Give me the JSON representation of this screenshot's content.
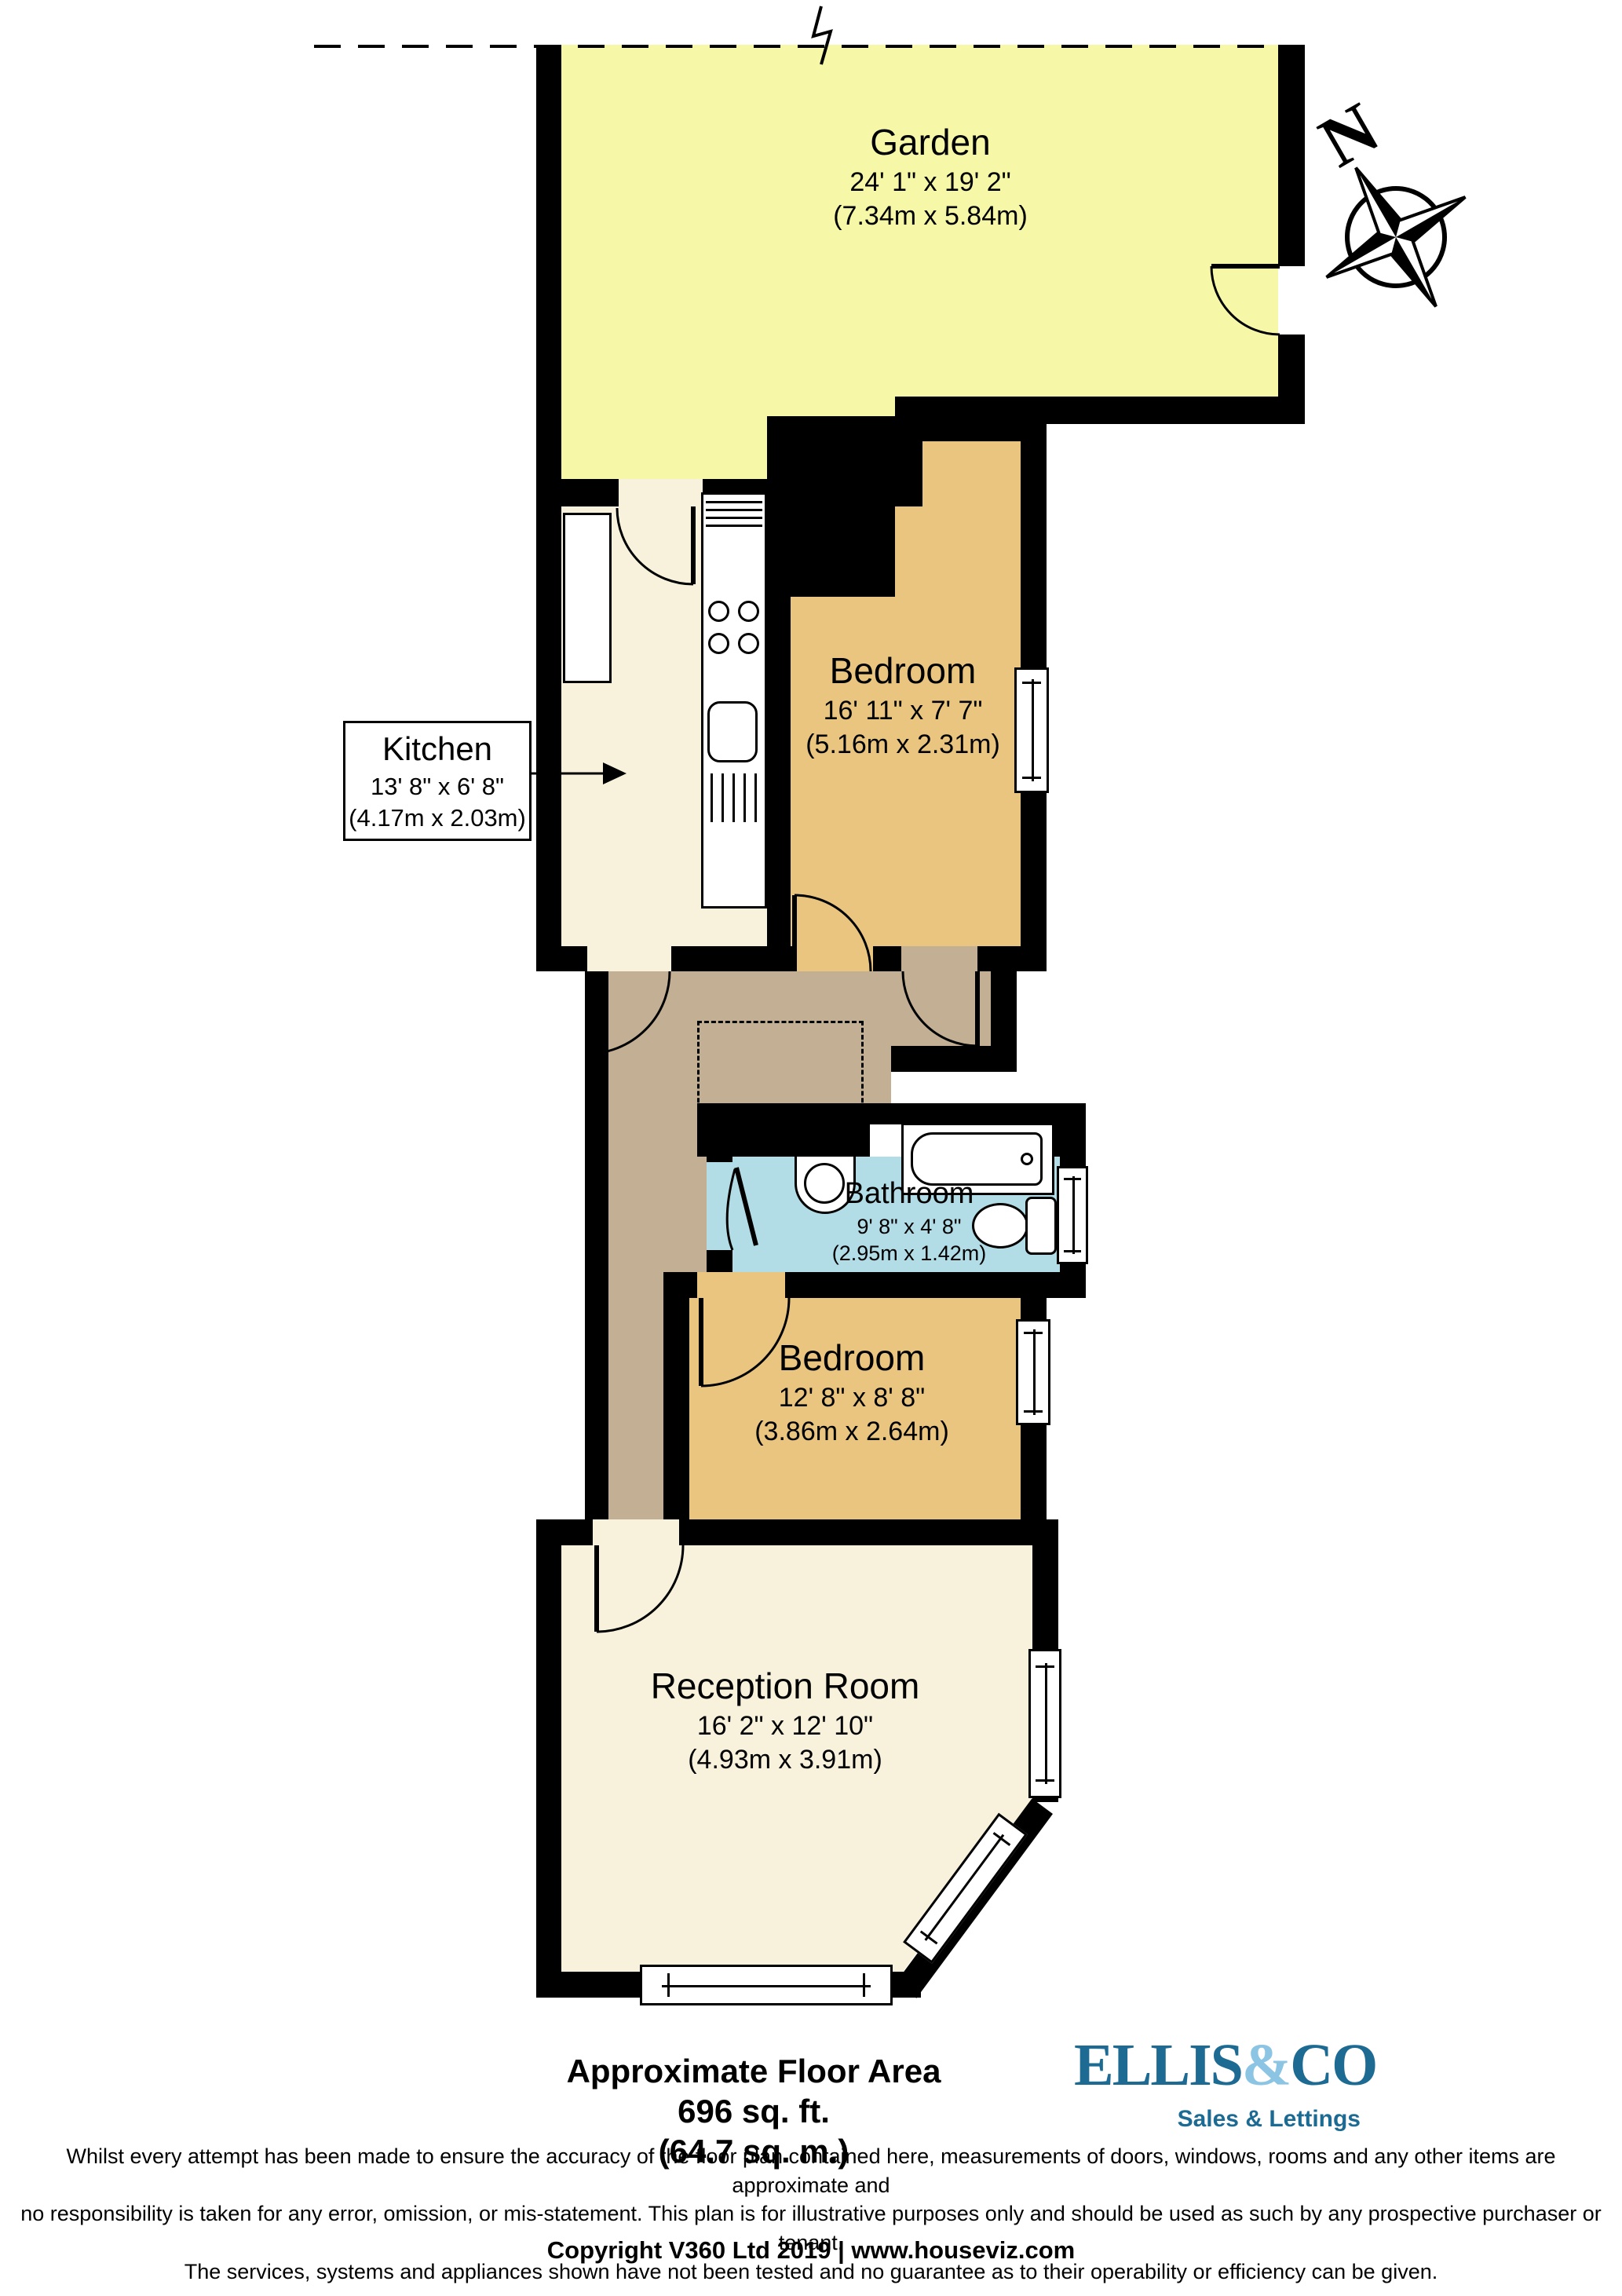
{
  "compass": {
    "label": "N"
  },
  "rooms": {
    "garden": {
      "name": "Garden",
      "dims_imperial": "24' 1\" x 19' 2\"",
      "dims_metric": "(7.34m x 5.84m)"
    },
    "kitchen": {
      "name": "Kitchen",
      "dims_imperial": "13' 8\" x 6' 8\"",
      "dims_metric": "(4.17m x 2.03m)"
    },
    "bedroom1": {
      "name": "Bedroom",
      "dims_imperial": "16' 11\" x 7' 7\"",
      "dims_metric": "(5.16m x 2.31m)"
    },
    "bathroom": {
      "name": "Bathroom",
      "dims_imperial": "9' 8\" x 4' 8\"",
      "dims_metric": "(2.95m x 1.42m)"
    },
    "bedroom2": {
      "name": "Bedroom",
      "dims_imperial": "12' 8\" x 8' 8\"",
      "dims_metric": "(3.86m x 2.64m)"
    },
    "reception": {
      "name": "Reception Room",
      "dims_imperial": "16' 2\" x 12' 10\"",
      "dims_metric": "(4.93m x 3.91m)"
    }
  },
  "floor_area": {
    "line1": "Approximate Floor Area",
    "line2": "696 sq. ft.",
    "line3": "(64.7 sq. m.)"
  },
  "logo": {
    "part1": "ELLIS",
    "amp": "&",
    "part2": "CO",
    "tagline": "Sales & Lettings",
    "color_dark": "#1d6b93",
    "color_light": "#8cc5e4"
  },
  "disclaimer": {
    "line1": "Whilst every attempt has been made to ensure the accuracy of the floor plan contained here, measurements of doors, windows, rooms and any other items are approximate and",
    "line2": "no responsibility is taken for any error, omission, or mis-statement. This plan is for illustrative purposes only and should be used as such by any prospective purchaser or tenant.",
    "line3": "The services, systems and appliances shown have not been tested and no guarantee as to their operability or efficiency can be given."
  },
  "copyright": "Copyright V360 Ltd 2019 | www.houseviz.com",
  "colors": {
    "garden": "#f6f8a7",
    "bedroom": "#eac580",
    "hallway": "#c2af94",
    "bathroom": "#b2dde7",
    "living": "#f8f1dc",
    "walls": "#000000"
  }
}
